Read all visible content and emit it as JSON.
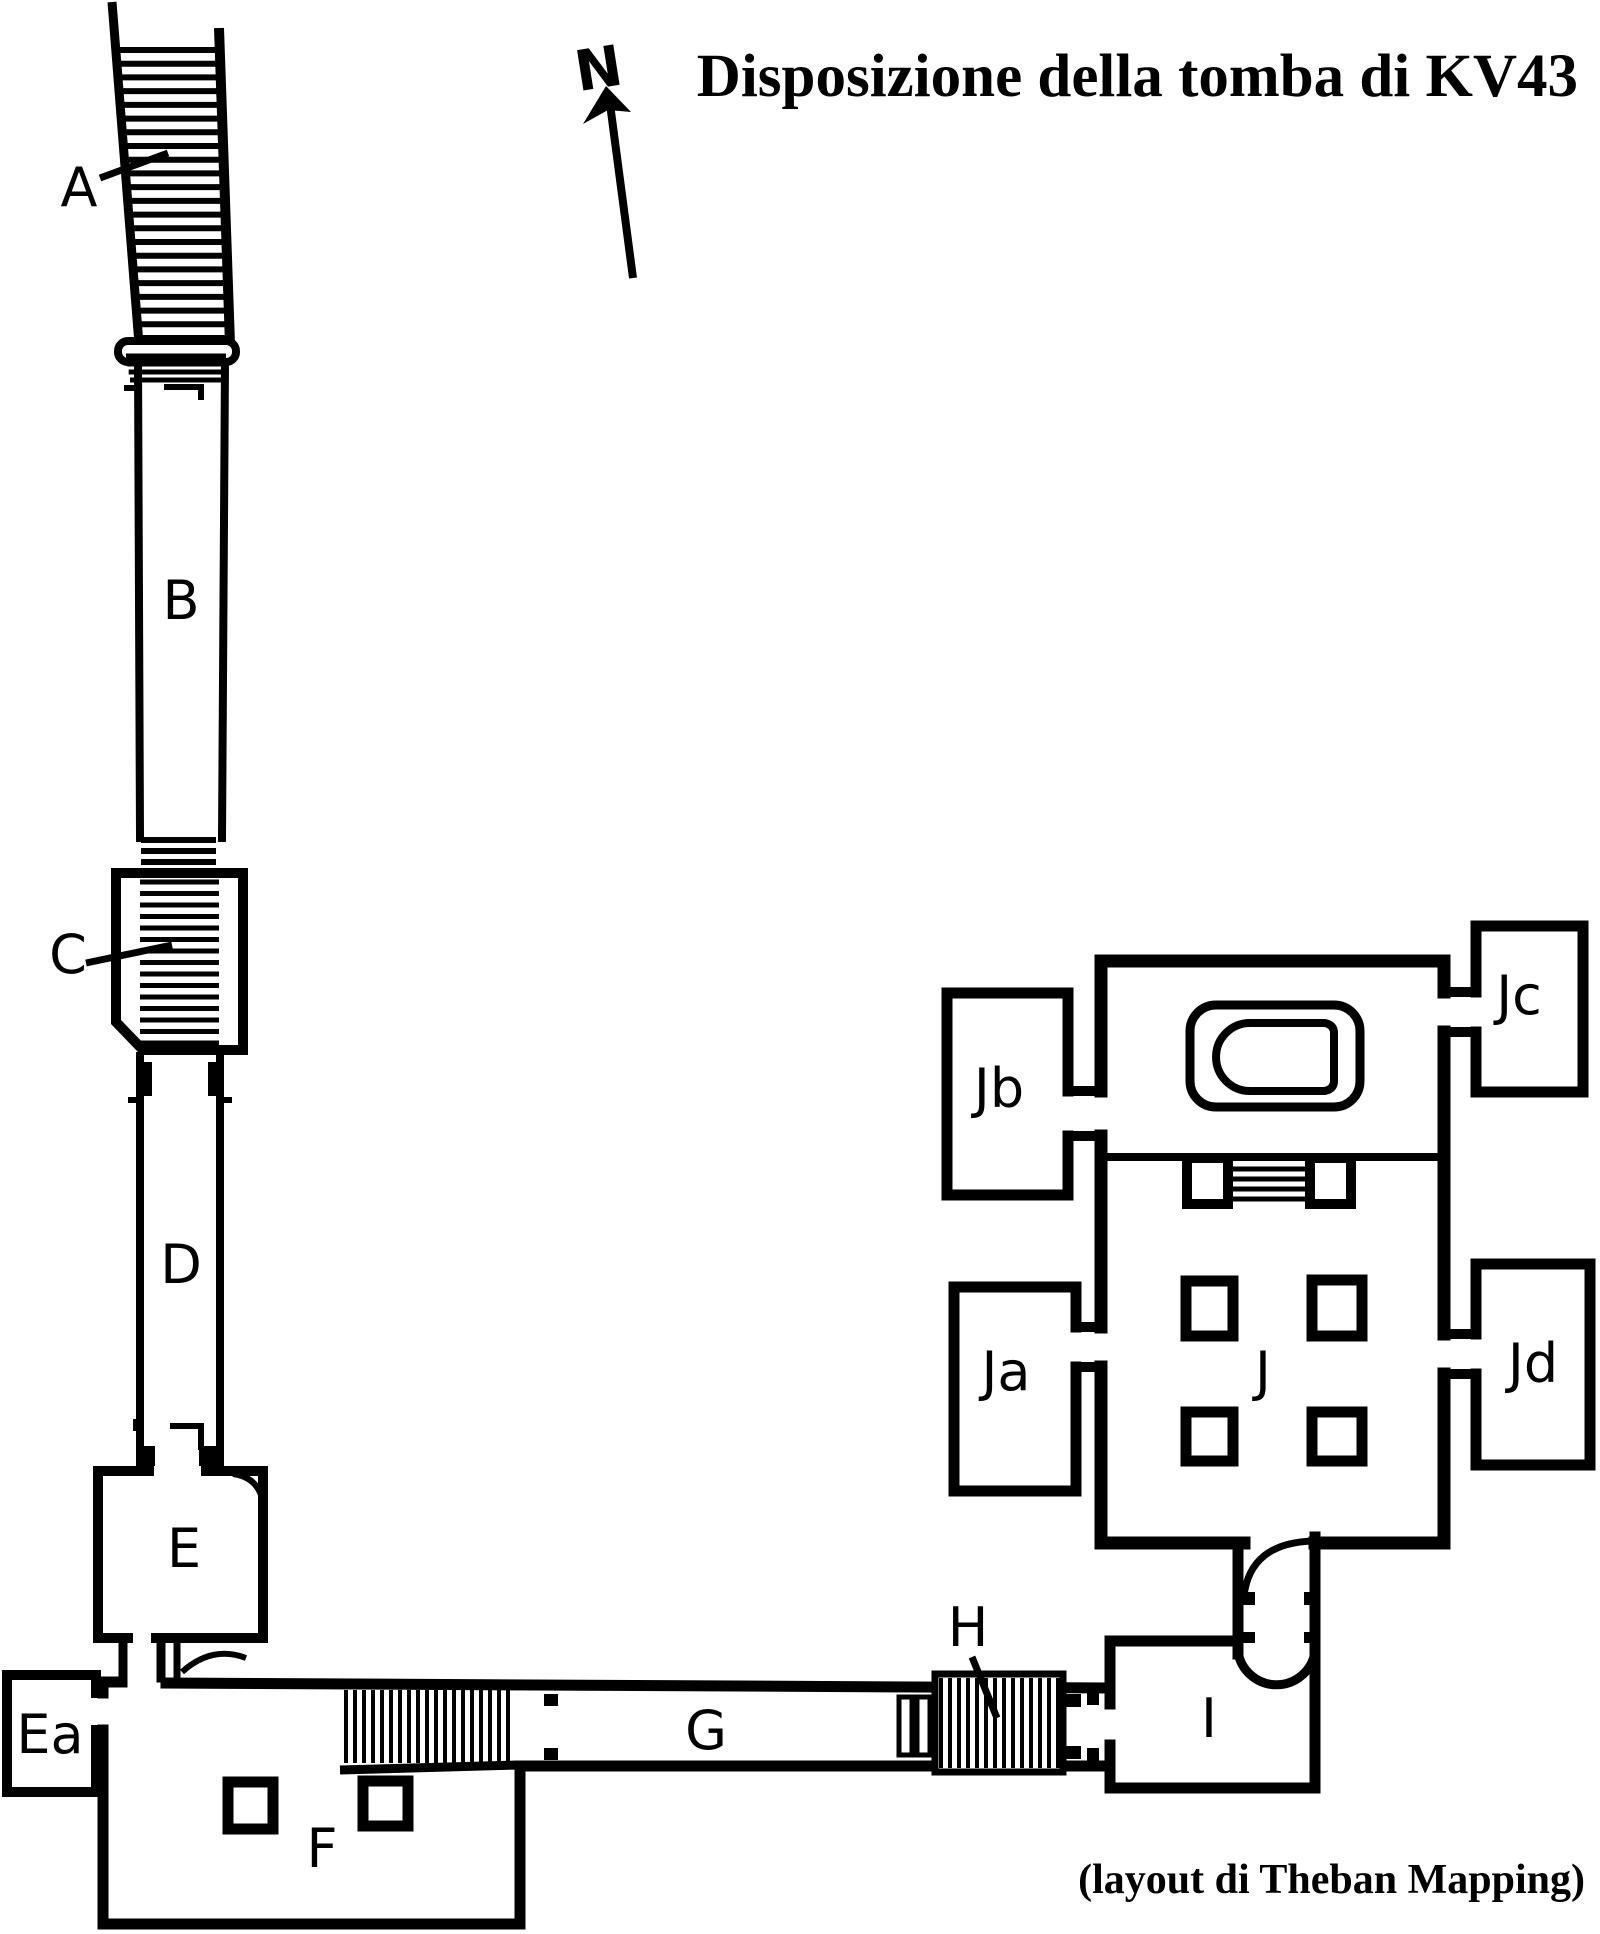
{
  "title": "Disposizione della tomba di KV43",
  "credit": "(layout di Theban Mapping)",
  "compass": {
    "label": "N"
  },
  "rooms": {
    "a": "A",
    "b": "B",
    "c": "C",
    "d": "D",
    "e": "E",
    "ea": "Ea",
    "f": "F",
    "g": "G",
    "h": "H",
    "i": "I",
    "j": "J",
    "ja": "Ja",
    "jb": "Jb",
    "jc": "Jc",
    "jd": "Jd"
  },
  "colors": {
    "ink": "#000000",
    "paper": "#ffffff"
  }
}
